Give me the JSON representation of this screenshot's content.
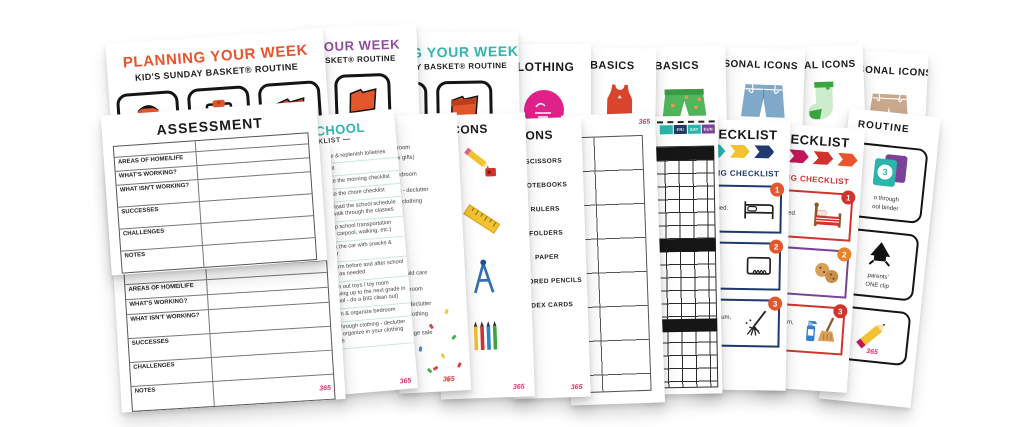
{
  "brand": {
    "logo_text": "365",
    "logo_color": "#d6336c"
  },
  "planning1": {
    "title": "PLANNING YOUR WEEK",
    "subtitle": "KID'S SUNDAY BASKET® ROUTINE",
    "title_color": "#e8542c",
    "icons": [
      "backpack-icon",
      "clipboard-icon",
      "folder-icon"
    ]
  },
  "planning2": {
    "title": "PLANNING YOUR WEEK",
    "subtitle": "KID'S SUNDAY BASKET® ROUTINE",
    "title_color": "#8e4d9e"
  },
  "planning3": {
    "title": "PLANNING YOUR WEEK",
    "subtitle": "KID'S SUNDAY BASKET® ROUTINE",
    "title_color": "#2fb5b0"
  },
  "clothing": {
    "title": "CLOTHING",
    "sticker_color": "#e0218a"
  },
  "basics1": {
    "title": "BASICS",
    "icon": "tank-top-icon"
  },
  "basics2": {
    "title": "BASICS",
    "icon": "green-shorts-icon"
  },
  "seasonal1": {
    "title": "SEASONAL ICONS",
    "icon": "denim-shorts-icon"
  },
  "seasonal2": {
    "title": "SEASONAL ICONS",
    "icon": "sock-icon",
    "caption": "Socks"
  },
  "seasonal3": {
    "title": "SEASONAL ICONS",
    "icon": "tan-shorts-icon"
  },
  "assessment1": {
    "title": "ASSESSMENT",
    "rows": [
      "AREAS OF HOME/LIFE",
      "WHAT'S WORKING?",
      "WHAT ISN'T WORKING?",
      "SUCCESSES",
      "CHALLENGES",
      "NOTES"
    ]
  },
  "assessment2": {
    "rows": [
      "AREAS OF HOME/LIFE",
      "WHAT'S WORKING?",
      "WHAT ISN'T WORKING?",
      "SUCCESSES",
      "CHALLENGES",
      "NOTES"
    ]
  },
  "school": {
    "title": "SCHOOL",
    "subtitle": "CHECKLIST —",
    "accent": "#2fb5b0",
    "items": [
      "update & replenish toiletries",
      "haircut",
      "update the morning checklist",
      "update the chore checklist",
      "download the school schedule and walk through the classes",
      "set up school transportation (bus, carpool, walking, etc.)",
      "stock the car with snacks & water",
      "confirm before and after school care as needed",
      "clean out toys / toy room (moving up to the next grade in school - do a BIG clean out)",
      "clean & organize bedroom",
      "go through clothing - declutter and organize in your clothing zone"
    ]
  },
  "partial_checklist": {
    "group1": [
      "y room",
      "ew gifts)",
      "bedroom",
      "ng - declutter",
      "ur clothing"
    ],
    "group2": [
      "r child care",
      "bedroom",
      "g - declutter",
      "ur clothing",
      "garage sale"
    ]
  },
  "supplies_icons_page": {
    "title": "ICONS",
    "icons": [
      "pencil-and-sharpener-icon",
      "ruler-icon",
      "compass-icon",
      "colored-pencils-icon"
    ]
  },
  "supplies_list_page": {
    "title": "ICONS",
    "items": [
      "SCISSORS",
      "NOTEBOOKS",
      "RULERS",
      "FOLDERS",
      "PAPER",
      "COLORED PENCILS",
      "INDEX CARDS"
    ]
  },
  "evening_page": {
    "label": "EVENING"
  },
  "week_grid_page": {
    "days": [
      {
        "label": "",
        "color": "#2bb5ac"
      },
      {
        "label": "FRI",
        "color": "#203864"
      },
      {
        "label": "SAT",
        "color": "#2bb5ac"
      },
      {
        "label": "SUN",
        "color": "#7b4397"
      }
    ]
  },
  "checklist_blue": {
    "title": "CHECKLIST",
    "subtitle": "MORNING CHECKLIST",
    "accent": "#1f3a6e",
    "chevrons": [
      "#2bb5ac",
      "#f2c230",
      "#1f3a6e"
    ],
    "items": [
      {
        "num": "1",
        "text": "r bed.",
        "icon": "bed-line-icon"
      },
      {
        "num": "2",
        "text": "d .",
        "icon": "wiping-hand-icon"
      },
      {
        "num": "3",
        "text": "ur uum, op).",
        "icon": "broom-line-icon"
      }
    ]
  },
  "checklist_pink": {
    "title": "CHECKLIST",
    "subtitle": "MORNING CHECKLIST",
    "accent": "#d0342c",
    "chevrons": [
      "#e0218a",
      "#c2185b",
      "#d0342c",
      "#e8542c"
    ],
    "items": [
      {
        "num": "1",
        "text": "r bed.",
        "icon": "bed-color-icon"
      },
      {
        "num": "2",
        "text": "d .",
        "icon": "snack-icon"
      },
      {
        "num": "3",
        "text": "ur uum, op).",
        "icon": "spray-broom-icon"
      }
    ]
  },
  "routine_page": {
    "title": "ROUTINE",
    "boxes": [
      {
        "badge": "3",
        "caption_line1": "o through",
        "caption_line2": "ool binder",
        "icon": "school-binder-icon"
      },
      {
        "badge": "",
        "caption_line1": "parents'",
        "caption_line2": "ONE clip",
        "icon": "clip-icon"
      },
      {
        "badge": "",
        "caption_line1": "",
        "caption_line2": "",
        "icon": "pencil-icon"
      }
    ]
  }
}
